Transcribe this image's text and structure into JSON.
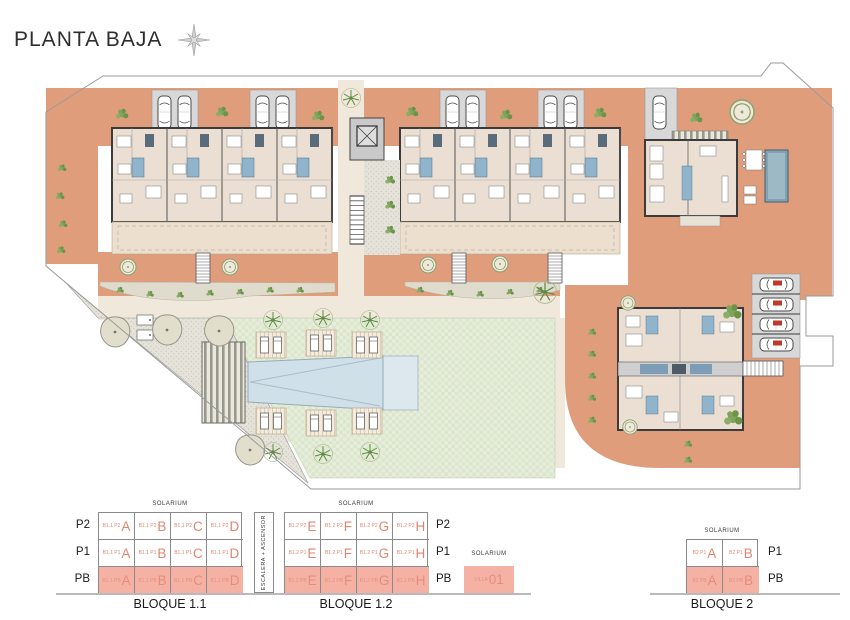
{
  "header": {
    "title": "PLANTA BAJA"
  },
  "colors": {
    "terracotta": "#DF9D7B",
    "highlight": "#F5B2A4",
    "letter": "#DF8672",
    "interior": "#EADFD2",
    "paving": "#F0E8DA",
    "asphalt": "#D8D8D8",
    "wall": "#3B3B3B",
    "lawn": "#E4EBD9",
    "pool": "#CFE0E8",
    "villa_pool": "#7FA3B5",
    "plant": "#7FA55C",
    "boundary": "#9A9A9A",
    "baseline": "#B9B9B9",
    "text": "#1F1F1F"
  },
  "legend": {
    "floors_left": [
      "P2",
      "P1",
      "PB"
    ],
    "floors_right": [
      "P2",
      "P1",
      "PB"
    ],
    "floors_right_b2": [
      "P1",
      "PB"
    ],
    "stairwell_label": "ESCALERA + ASCENSOR",
    "b11": {
      "label": "BLOQUE 1.1",
      "solarium": "SOLARIUM",
      "rows": [
        {
          "floor": "P2",
          "cells": [
            {
              "code": "B1.1 P2",
              "unit": "A"
            },
            {
              "code": "B1.1 P2",
              "unit": "B"
            },
            {
              "code": "B1.1 P2",
              "unit": "C"
            },
            {
              "code": "B1.1 P2",
              "unit": "D"
            }
          ]
        },
        {
          "floor": "P1",
          "cells": [
            {
              "code": "B1.1 P1",
              "unit": "A"
            },
            {
              "code": "B1.1 P1",
              "unit": "B"
            },
            {
              "code": "B1.1 P1",
              "unit": "C"
            },
            {
              "code": "B1.1 P1",
              "unit": "D"
            }
          ]
        },
        {
          "floor": "PB",
          "cells": [
            {
              "code": "B1.1 PB",
              "unit": "A"
            },
            {
              "code": "B1.1 PB",
              "unit": "B"
            },
            {
              "code": "B1.1 PB",
              "unit": "C"
            },
            {
              "code": "B1.1 PB",
              "unit": "D"
            }
          ]
        }
      ]
    },
    "b12": {
      "label": "BLOQUE 1.2",
      "solarium": "SOLARIUM",
      "rows": [
        {
          "floor": "P2",
          "cells": [
            {
              "code": "B1.2 P2",
              "unit": "E"
            },
            {
              "code": "B1.2 P2",
              "unit": "F"
            },
            {
              "code": "B1.2 P2",
              "unit": "G"
            },
            {
              "code": "B1.2 P2",
              "unit": "H"
            }
          ]
        },
        {
          "floor": "P1",
          "cells": [
            {
              "code": "B1.2 P1",
              "unit": "E"
            },
            {
              "code": "B1.2 P1",
              "unit": "F"
            },
            {
              "code": "B1.2 P1",
              "unit": "G"
            },
            {
              "code": "B1.2 P1",
              "unit": "H"
            }
          ]
        },
        {
          "floor": "PB",
          "cells": [
            {
              "code": "B1.2 PB",
              "unit": "E"
            },
            {
              "code": "B1.2 PB",
              "unit": "F"
            },
            {
              "code": "B1.2 PB",
              "unit": "G"
            },
            {
              "code": "B1.2 PB",
              "unit": "H"
            }
          ]
        }
      ]
    },
    "villa": {
      "solarium": "SOLARIUM",
      "code": "VILLA",
      "unit": "01"
    },
    "b2": {
      "label": "BLOQUE 2",
      "solarium": "SOLARIUM",
      "rows": [
        {
          "floor": "P1",
          "cells": [
            {
              "code": "B2 P1",
              "unit": "A"
            },
            {
              "code": "B2 P1",
              "unit": "B"
            }
          ]
        },
        {
          "floor": "PB",
          "cells": [
            {
              "code": "B2 PB",
              "unit": "A"
            },
            {
              "code": "B2 PB",
              "unit": "B"
            }
          ]
        }
      ]
    }
  }
}
